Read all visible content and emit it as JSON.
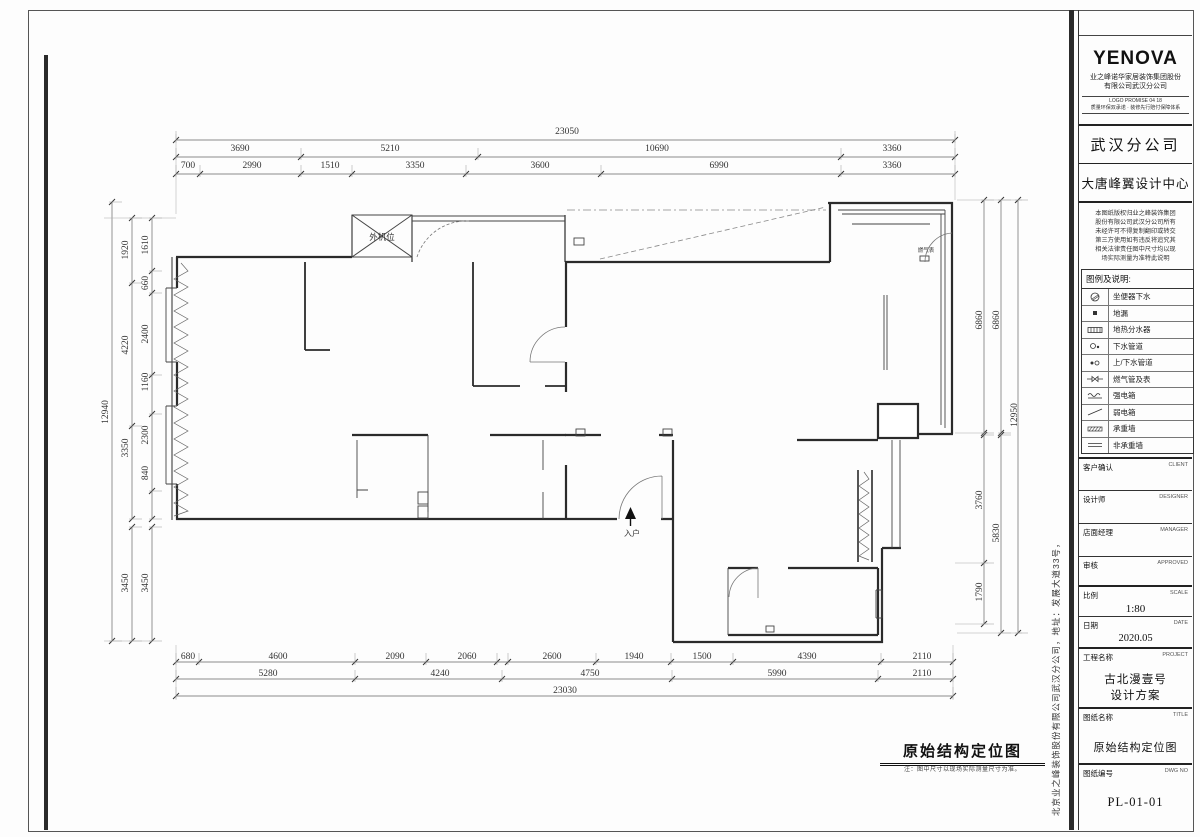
{
  "colors": {
    "line": "#2b2b2b",
    "dim": "#3a3a3a",
    "text": "#111111"
  },
  "titleblock": {
    "logo": "YENOVA",
    "company_line1": "业之峰诺华家居装饰集团股份",
    "company_line2": "有限公司武汉分公司",
    "tagline_line1": "LOGO PROMISE 04 18",
    "tagline_line2": "质量环保双承诺 · 装修先行赔付保障体系",
    "branch": "武汉分公司",
    "design_center": "大唐峰翼设计中心",
    "notice_lines": [
      "本图纸版权归业之峰装饰集团",
      "股份有限公司武汉分公司所有",
      "未经许可不得复制翻印或转交",
      "第三方使用如有违反将追究其",
      "相关法律责任图中尺寸均以现",
      "场实际测量为准特此说明"
    ],
    "legend": {
      "title": "图例及说明:",
      "items": [
        "坐便器下水",
        "地漏",
        "地热分水器",
        "下水管道",
        "上/下水管道",
        "燃气管及表",
        "强电箱",
        "弱电箱",
        "承重墙",
        "非承重墙"
      ]
    },
    "fields": [
      {
        "cn": "客户确认",
        "en": "CLIENT",
        "value": ""
      },
      {
        "cn": "设计师",
        "en": "DESIGNER",
        "value": ""
      },
      {
        "cn": "店面经理",
        "en": "MANAGER",
        "value": ""
      },
      {
        "cn": "审核",
        "en": "APPROVED",
        "value": ""
      },
      {
        "cn": "比例",
        "en": "SCALE",
        "value": "1:80"
      },
      {
        "cn": "日期",
        "en": "DATE",
        "value": "2020.05"
      },
      {
        "cn": "工程名称",
        "en": "PROJECT",
        "value_lines": [
          "古北漫壹号",
          "设计方案"
        ]
      },
      {
        "cn": "图纸名称",
        "en": "TITLE",
        "value": "原始结构定位图"
      },
      {
        "cn": "图纸编号",
        "en": "DWG NO",
        "value": "PL-01-01"
      }
    ],
    "side_text": "北京业之峰装饰股份有限公司武汉分公司，地址：发展大道33号，"
  },
  "plan": {
    "title": "原始结构定位图",
    "note": "注：图中尺寸以现场实际测量尺寸为准。",
    "labels": [
      {
        "t": "外机位",
        "x": 382,
        "y": 240,
        "s": 8.5
      },
      {
        "t": "入户",
        "x": 632,
        "y": 536,
        "s": 8
      },
      {
        "t": "燃气表",
        "x": 926,
        "y": 252,
        "s": 5.5
      }
    ],
    "dims": [
      {
        "t": "23050",
        "x": 567,
        "y": 134
      },
      {
        "t": "3690",
        "x": 240,
        "y": 151
      },
      {
        "t": "5210",
        "x": 390,
        "y": 151
      },
      {
        "t": "10690",
        "x": 657,
        "y": 151
      },
      {
        "t": "3360",
        "x": 892,
        "y": 151
      },
      {
        "t": "700",
        "x": 188,
        "y": 168
      },
      {
        "t": "2990",
        "x": 252,
        "y": 168
      },
      {
        "t": "1510",
        "x": 330,
        "y": 168
      },
      {
        "t": "3350",
        "x": 415,
        "y": 168
      },
      {
        "t": "3600",
        "x": 540,
        "y": 168
      },
      {
        "t": "6990",
        "x": 719,
        "y": 168
      },
      {
        "t": "3360",
        "x": 892,
        "y": 168
      },
      {
        "t": "680",
        "x": 188,
        "y": 659
      },
      {
        "t": "4600",
        "x": 278,
        "y": 659
      },
      {
        "t": "2090",
        "x": 395,
        "y": 659
      },
      {
        "t": "2060",
        "x": 467,
        "y": 659
      },
      {
        "t": "2600",
        "x": 552,
        "y": 659
      },
      {
        "t": "1940",
        "x": 634,
        "y": 659
      },
      {
        "t": "1500",
        "x": 702,
        "y": 659
      },
      {
        "t": "4390",
        "x": 807,
        "y": 659
      },
      {
        "t": "2110",
        "x": 922,
        "y": 659
      },
      {
        "t": "5280",
        "x": 268,
        "y": 676
      },
      {
        "t": "4240",
        "x": 440,
        "y": 676
      },
      {
        "t": "4750",
        "x": 590,
        "y": 676
      },
      {
        "t": "5990",
        "x": 777,
        "y": 676
      },
      {
        "t": "2110",
        "x": 922,
        "y": 676
      },
      {
        "t": "23030",
        "x": 565,
        "y": 693
      },
      {
        "t": "1920",
        "x": 128,
        "y": 250,
        "r": -90
      },
      {
        "t": "1610",
        "x": 148,
        "y": 245,
        "r": -90
      },
      {
        "t": "660",
        "x": 148,
        "y": 283,
        "r": -90
      },
      {
        "t": "4220",
        "x": 128,
        "y": 345,
        "r": -90
      },
      {
        "t": "2400",
        "x": 148,
        "y": 334,
        "r": -90
      },
      {
        "t": "1160",
        "x": 148,
        "y": 382,
        "r": -90
      },
      {
        "t": "12940",
        "x": 108,
        "y": 412,
        "r": -90
      },
      {
        "t": "3350",
        "x": 128,
        "y": 448,
        "r": -90
      },
      {
        "t": "2300",
        "x": 148,
        "y": 435,
        "r": -90
      },
      {
        "t": "840",
        "x": 148,
        "y": 473,
        "r": -90
      },
      {
        "t": "3450",
        "x": 128,
        "y": 583,
        "r": -90
      },
      {
        "t": "3450",
        "x": 148,
        "y": 583,
        "r": -90
      },
      {
        "t": "6860",
        "x": 982,
        "y": 320,
        "r": -90
      },
      {
        "t": "6860",
        "x": 999,
        "y": 320,
        "r": -90
      },
      {
        "t": "12950",
        "x": 1017,
        "y": 415,
        "r": -90
      },
      {
        "t": "3760",
        "x": 982,
        "y": 500,
        "r": -90
      },
      {
        "t": "5830",
        "x": 999,
        "y": 533,
        "r": -90
      },
      {
        "t": "1790",
        "x": 982,
        "y": 592,
        "r": -90
      }
    ]
  }
}
